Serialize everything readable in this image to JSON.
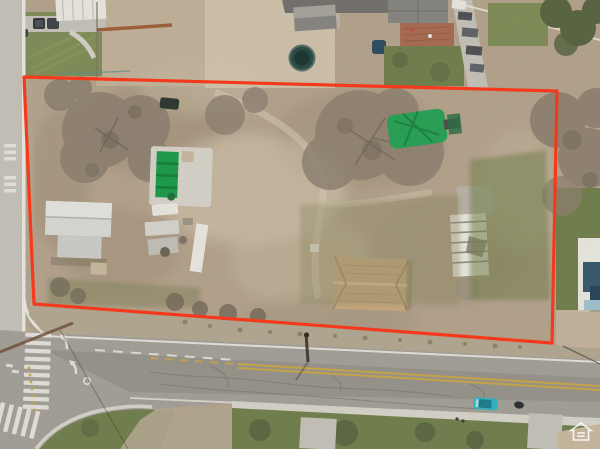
{
  "scene": {
    "type": "aerial-drone-photo",
    "description": "Overhead aerial photo of a large vacant dirt parcel outlined in red; inside the lot are a small white house, a green-covered swimming pool, sheds, trailers, a tan-roofed house, a white barn and bare trees. Residential neighbors line the top edge, a street runs along the left edge, and a wide road with intersection markings, crosswalks and a teal car crosses the bottom. A small white Equal Housing Opportunity watermark sits in the lower-right corner.",
    "boundary": {
      "color": "#f5391c",
      "corners": [
        [
          24,
          77
        ],
        [
          557,
          91
        ],
        [
          552,
          343
        ],
        [
          34,
          304
        ]
      ]
    },
    "watermark": {
      "label": "equal-housing-opportunity",
      "color": "#ffffff"
    }
  },
  "palette": {
    "dirt": "#b4a28b",
    "dirtL": "#c8b89f",
    "dirtD": "#998771",
    "dirtP": "#d9ccb5",
    "gravel": "#b2a791",
    "olive": "#6e7d49",
    "oliveD": "#55613e",
    "lawn": "#7d8c55",
    "road": "#c5c2ba",
    "asph": "#a29f98",
    "asphD": "#8a8780",
    "conc": "#d7d4cb",
    "white": "#ebe9e2",
    "roofG": "#85837e",
    "roofD": "#706e6a",
    "roofTan": "#c9a87d",
    "houseW": "#dadad6",
    "pool": "#169a47",
    "poolD": "#0f7c38",
    "tarp": "#21a052",
    "tramp": "#24453f",
    "teal": "#2ab3c4",
    "carD": "#262b31",
    "yellow": "#c9a545",
    "tree": "#8b7e6e",
    "treeD": "#6e6354",
    "treeG": "#55613e",
    "terracotta": "#a8684f"
  }
}
